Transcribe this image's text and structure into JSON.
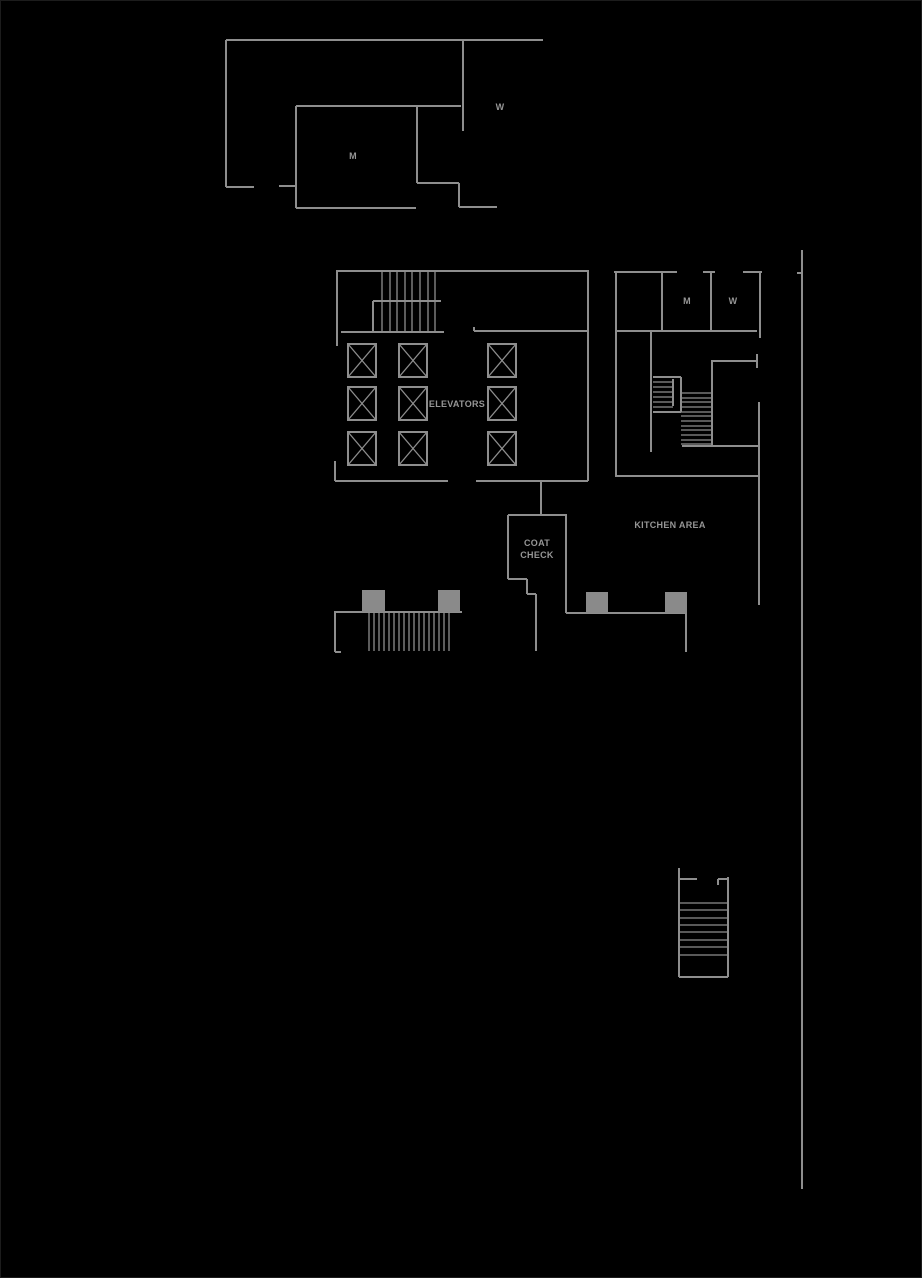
{
  "app": {
    "description": "Building floor plan line drawing on black background"
  },
  "canvas": {
    "width": 922,
    "height": 1278,
    "background": "#000000",
    "wall_color": "#8e8e8e",
    "fill_color": "#8a8a8a",
    "text_color": "#969696",
    "border_color": "#1c1c1c",
    "label_font_size": 9
  },
  "labels": [
    {
      "id": "upper-mens-room",
      "text": "M",
      "x": 353,
      "y": 159
    },
    {
      "id": "upper-womens-room",
      "text": "W",
      "x": 500,
      "y": 110
    },
    {
      "id": "elevators",
      "text": "ELEVATORS",
      "x": 457,
      "y": 407
    },
    {
      "id": "right-mens-room",
      "text": "M",
      "x": 687,
      "y": 304
    },
    {
      "id": "right-womens-room",
      "text": "W",
      "x": 733,
      "y": 304
    },
    {
      "id": "kitchen-area",
      "text": "KITCHEN AREA",
      "x": 670,
      "y": 528
    },
    {
      "id": "coat-check-line1",
      "text": "COAT",
      "x": 537,
      "y": 546
    },
    {
      "id": "coat-check-line2",
      "text": "CHECK",
      "x": 537,
      "y": 558
    }
  ],
  "plan": {
    "walls": [
      [
        226,
        40,
        543,
        40
      ],
      [
        226,
        40,
        226,
        187
      ],
      [
        226,
        187,
        254,
        187
      ],
      [
        279,
        186,
        296,
        186
      ],
      [
        463,
        40,
        463,
        131
      ],
      [
        296,
        106,
        461,
        106
      ],
      [
        296,
        106,
        296,
        208
      ],
      [
        296,
        208,
        416,
        208
      ],
      [
        417,
        106,
        417,
        183
      ],
      [
        417,
        183,
        459,
        183
      ],
      [
        459,
        183,
        459,
        207
      ],
      [
        459,
        207,
        497,
        207
      ],
      [
        336,
        271,
        589,
        271
      ],
      [
        337,
        271,
        337,
        346
      ],
      [
        341,
        332,
        444,
        332
      ],
      [
        373,
        301,
        441,
        301
      ],
      [
        373,
        301,
        373,
        332
      ],
      [
        474,
        327,
        474,
        331
      ],
      [
        474,
        331,
        587,
        331
      ],
      [
        588,
        271,
        588,
        481
      ],
      [
        335,
        461,
        335,
        481
      ],
      [
        335,
        481,
        448,
        481
      ],
      [
        476,
        481,
        588,
        481
      ],
      [
        541,
        481,
        541,
        516
      ],
      [
        508,
        515,
        567,
        515
      ],
      [
        508,
        515,
        508,
        579
      ],
      [
        508,
        579,
        527,
        579
      ],
      [
        527,
        579,
        527,
        594
      ],
      [
        527,
        594,
        536,
        594
      ],
      [
        536,
        594,
        536,
        651
      ],
      [
        566,
        515,
        566,
        613
      ],
      [
        566,
        613,
        686,
        613
      ],
      [
        686,
        613,
        686,
        652
      ],
      [
        334,
        612,
        462,
        612
      ],
      [
        335,
        612,
        335,
        652
      ],
      [
        335,
        652,
        341,
        652
      ],
      [
        614,
        272,
        677,
        272
      ],
      [
        703,
        272,
        715,
        272
      ],
      [
        743,
        272,
        762,
        272
      ],
      [
        616,
        272,
        616,
        477
      ],
      [
        662,
        272,
        662,
        331
      ],
      [
        711,
        272,
        711,
        331
      ],
      [
        760,
        272,
        760,
        338
      ],
      [
        616,
        331,
        757,
        331
      ],
      [
        651,
        331,
        651,
        452
      ],
      [
        616,
        476,
        759,
        476
      ],
      [
        712,
        360,
        712,
        445
      ],
      [
        712,
        361,
        757,
        361
      ],
      [
        757,
        354,
        757,
        368
      ],
      [
        759,
        402,
        759,
        605
      ],
      [
        682,
        446,
        758,
        446
      ],
      [
        653,
        377,
        681,
        377
      ],
      [
        653,
        412,
        681,
        412
      ],
      [
        681,
        377,
        681,
        412
      ],
      [
        673,
        379,
        673,
        406
      ],
      [
        679,
        868,
        679,
        977
      ],
      [
        679,
        879,
        697,
        879
      ],
      [
        718,
        879,
        728,
        879
      ],
      [
        718,
        879,
        718,
        885
      ],
      [
        728,
        877,
        728,
        977
      ],
      [
        679,
        977,
        728,
        977
      ],
      [
        802,
        250,
        802,
        1189
      ],
      [
        797,
        273,
        802,
        273
      ]
    ],
    "stairs": [
      {
        "name": "lobby-stair",
        "orientation": "vertical",
        "tread_xs": [
          382,
          390,
          397,
          405,
          412,
          420,
          428,
          435
        ],
        "y1": 271,
        "y2": 332
      },
      {
        "name": "lower-lobby-stair",
        "orientation": "vertical",
        "tread_xs": [
          369,
          374,
          379,
          384,
          389,
          394,
          399,
          404,
          409,
          414,
          419,
          424,
          429,
          434,
          439,
          444,
          449
        ],
        "y1": 612,
        "y2": 651
      },
      {
        "name": "right-stair-upper",
        "orientation": "horizontal",
        "tread_ys": [
          382,
          387,
          392,
          397,
          402,
          407
        ],
        "x1": 653,
        "x2": 673
      },
      {
        "name": "right-stair-lower",
        "orientation": "horizontal",
        "tread_ys": [
          393,
          398,
          402,
          407,
          412,
          416,
          421,
          426,
          430,
          435,
          440,
          444
        ],
        "x1": 681,
        "x2": 712
      },
      {
        "name": "exit-stair",
        "orientation": "horizontal",
        "tread_ys": [
          903,
          910,
          918,
          925,
          932,
          940,
          947,
          955
        ],
        "x1": 679,
        "x2": 728
      }
    ],
    "elevators": {
      "cols": [
        348,
        399,
        488
      ],
      "rows": [
        344,
        387,
        432
      ],
      "w": 28,
      "h": 33
    },
    "blocks": [
      [
        362,
        590,
        23,
        22
      ],
      [
        438,
        590,
        22,
        22
      ],
      [
        586,
        592,
        22,
        21
      ],
      [
        665,
        592,
        22,
        21
      ]
    ]
  }
}
